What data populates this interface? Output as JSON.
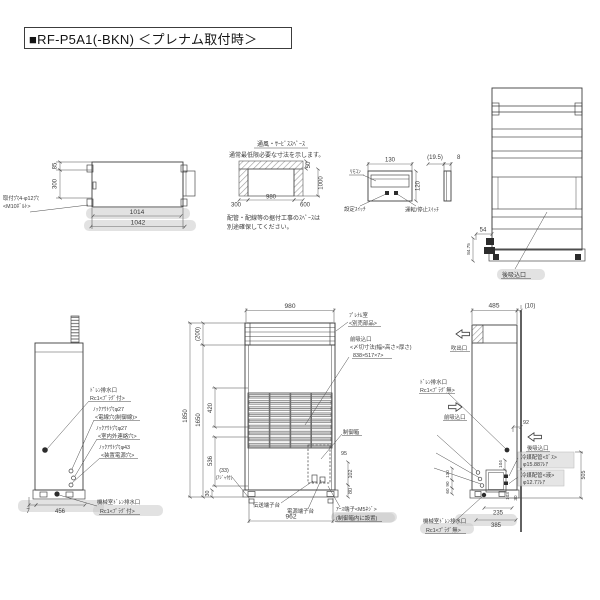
{
  "title": "■RF-P5A1(-BKN)  ＜プレナム取付時＞",
  "top_view": {
    "dim_inner_width": "1014",
    "dim_outer_width": "1042",
    "dim_depth_top": "85",
    "dim_depth": "300",
    "mount_hole_line1": "取付穴4-φ12穴",
    "mount_hole_line2": "<M10ﾎﾞﾙﾄ>"
  },
  "service_space": {
    "heading": "通風・ｻｰﾋﾞｽｽﾍﾟｰｽ",
    "subheading": "通常最低限必要な寸法を示します。",
    "dim_left": "300",
    "dim_center": "980",
    "dim_right": "600",
    "dim_top": "50",
    "dim_side": "1000",
    "note_line1": "配管・配線等の据付工事のｽﾍﾟｰｽは",
    "note_line2": "別途確保してください。"
  },
  "control_panel": {
    "dim_width": "130",
    "dim_height": "120",
    "dim_depth": "(19.5)",
    "dim_thickness": "8",
    "remote_label": "ﾘﾓｺﾝ",
    "setting_switch_label": "設定ｽｲｯﾁ",
    "run_stop_switch_label": "運転/停止ｽｲｯﾁ"
  },
  "rear_view": {
    "dim_54": "54",
    "dim_8475": "84.75",
    "rear_inlet_label": "後吸込口"
  },
  "left_side_view": {
    "drain_line1": "ﾄﾞﾚﾝ排水口",
    "drain_line2": "Rc1<ﾌﾟﾗｸﾞ付>",
    "knockout27a_line1": "ﾉｯｸｱｳﾄ穴φ27",
    "knockout27a_line2": "<電線穴(制御線)>",
    "knockout27b_line1": "ﾉｯｸｱｳﾄ穴φ27",
    "knockout27b_line2": "<室内外連絡穴>",
    "knockout43_line1": "ﾉｯｸｱｳﾄ穴φ43",
    "knockout43_line2": "<装置電源穴>",
    "dim_7": "7",
    "dim_456": "456",
    "machine_drain_line1": "機械室ﾄﾞﾚﾝ排水口",
    "machine_drain_line2": "Rc1<ﾌﾟﾗｸﾞ付>"
  },
  "front_view": {
    "dim_980": "980",
    "dim_200": "(200)",
    "dim_1850": "1850",
    "dim_1650": "1650",
    "dim_420": "420",
    "dim_536": "536",
    "dim_33": "(33)",
    "adjuster_note": "(ｱｼﾞｬ付)",
    "dim_30": "30",
    "dim_95": "95",
    "dim_102": "102",
    "dim_80": "80",
    "dim_962": "962",
    "plenum_line1": "ﾌﾟﾚﾅﾑ室",
    "plenum_line2": "<別売部品>",
    "front_inlet_line1": "前吸込口",
    "front_inlet_line2": "<〆切寸法(幅×高さ×厚さ)",
    "front_inlet_line3": "838×517×7>",
    "control_box_label": "制御箱",
    "transmission_terminal_label": "伝送端子台",
    "power_terminal_label": "電源端子台",
    "earth_terminal_line1": "ｱｰｽ端子<M5ﾈｼﾞ>",
    "earth_terminal_line2": "(制御箱内に設置)"
  },
  "right_side_view": {
    "dim_485": "485",
    "dim_10": "(10)",
    "blow_outlet_label": "吹出口",
    "drain_line1": "ﾄﾞﾚﾝ排水口",
    "drain_line2": "Rc1<ﾌﾟﾗｸﾞ無>",
    "front_inlet_label": "前吸込口",
    "dim_92": "92",
    "rear_inlet_label": "後吸込口",
    "gas_pipe_line1": "冷媒配管<ｶﾞｽ>",
    "gas_pipe_line2": "φ15.88ﾌﾚｱ",
    "liquid_pipe_line1": "冷媒配管<液>",
    "liquid_pipe_line2": "φ12.7ﾌﾚｱ",
    "dim_505": "505",
    "dim_104": "104",
    "dim_130": "130",
    "dim_90": "90",
    "dim_60": "60",
    "dim_235": "235",
    "dim_385": "385",
    "dim_30": "30",
    "dim_103": "103",
    "machine_drain_line1": "機械室ﾄﾞﾚﾝ排水口",
    "machine_drain_line2": "Rc1<ﾌﾟﾗｸﾞ無>"
  }
}
